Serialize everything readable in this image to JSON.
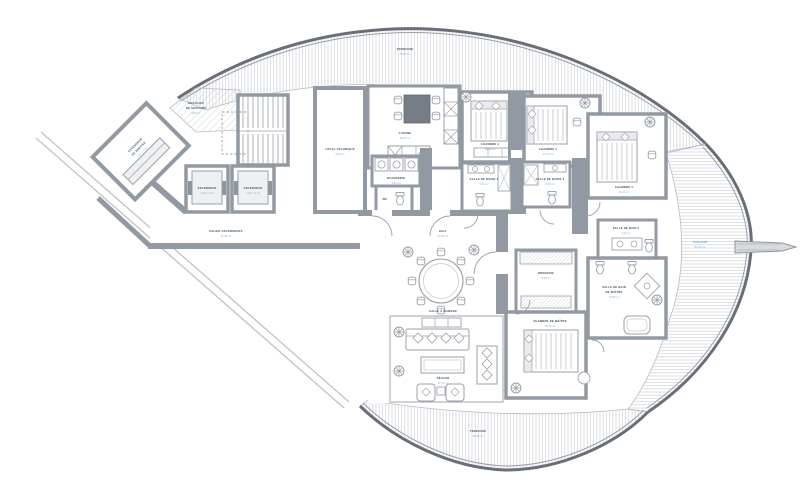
{
  "plan": {
    "colors": {
      "wall": "#9299a2",
      "wall_dark": "#6a6f77",
      "label": "#3c4a57",
      "dims": "#7fb2d6",
      "hatch": "#cdd0d4"
    },
    "terraces": {
      "top": {
        "name": "TERRASSE",
        "dims": "45.80 m²"
      },
      "right": {
        "name": "TERRASSE",
        "dims": "62.40 m²"
      },
      "bottom": {
        "name": "TERRASSE",
        "dims": "38.60 m²"
      }
    },
    "rooms": {
      "escalier_secours": {
        "l1": "ESCALIER",
        "l2": "DE SECOURS",
        "dims": "8.50 m²"
      },
      "asc_service": {
        "l1": "ASCENSEUR",
        "l2": "DE SERVICE",
        "dims": "2.10 × 1.60"
      },
      "ascenseur_a": {
        "name": "ASCENSEUR",
        "dims": "1.60 × 2.10"
      },
      "ascenseur_b": {
        "name": "ASCENSEUR",
        "dims": "1.60 × 2.10"
      },
      "palier": {
        "name": "PALIER ASCENSEURS",
        "dims": "12.40 m²"
      },
      "local_technique": {
        "name": "LOCAL TECHNIQUE",
        "dims": "9.80 m²"
      },
      "buanderie": {
        "name": "BUANDERIE",
        "dims": "4.20 m²"
      },
      "wc": {
        "name": "WC"
      },
      "cuisine": {
        "name": "CUISINE",
        "dims": "18.60 m²"
      },
      "hall": {
        "name": "HALL",
        "dims": "32.50 m²"
      },
      "salle_a_manger": {
        "name": "SALLE À MANGER",
        "dims": "24.30 m²"
      },
      "sejour": {
        "name": "SÉJOUR",
        "dims": "42.70 m²"
      },
      "chambre4": {
        "name": "CHAMBRE 4",
        "dims": "16.80 m²"
      },
      "sdb4": {
        "name": "SALLE DE BAINS 4",
        "dims": "5.40 m²"
      },
      "chambre3": {
        "name": "CHAMBRE 3",
        "dims": "17.20 m²"
      },
      "sdb3": {
        "name": "SALLE DE BAINS 3",
        "dims": "5.60 m²"
      },
      "chambre2": {
        "name": "CHAMBRE 2",
        "dims": "19.40 m²"
      },
      "sdb2": {
        "name": "SALLE DE BAIN 2",
        "dims": "6.20 m²"
      },
      "dressing": {
        "name": "DRESSING",
        "dims": "8.90 m²"
      },
      "chambre_maitre": {
        "name": "CHAMBRE DE MAÎTRE",
        "dims": "28.60 m²"
      },
      "sdb_maitre": {
        "l1": "SALLE DE BAIN",
        "l2": "DE MAÎTRE",
        "dims": "14.50 m²"
      }
    }
  }
}
